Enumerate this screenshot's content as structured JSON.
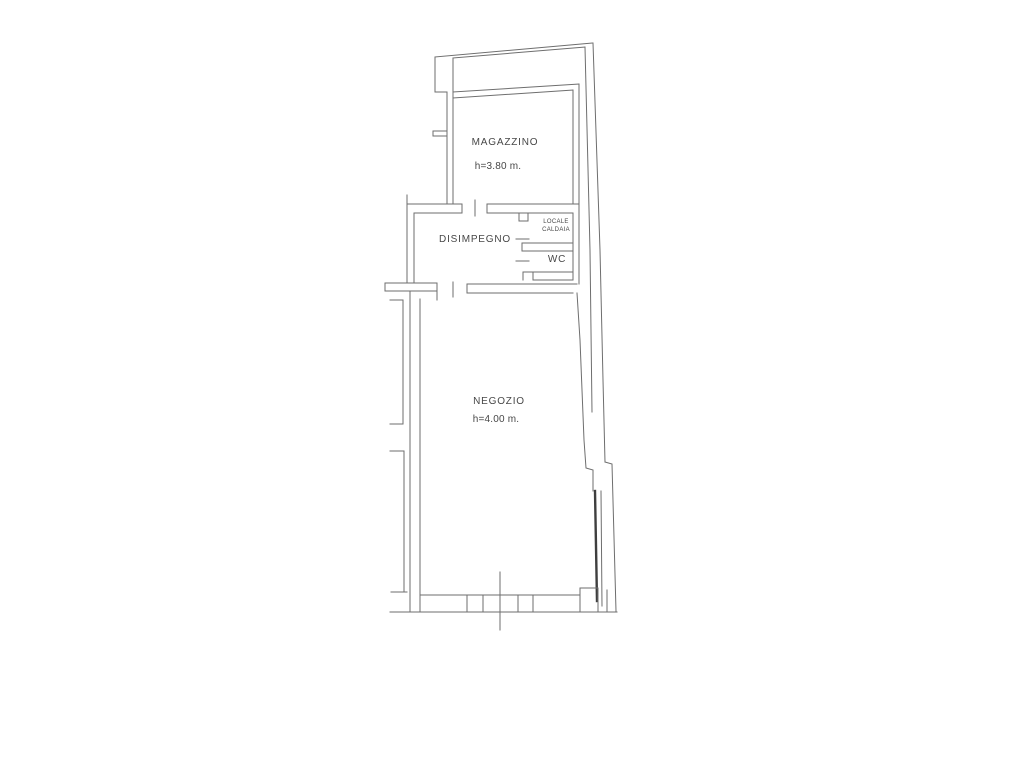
{
  "document_type": "floor-plan-scan",
  "colors": {
    "background": "#ffffff",
    "line": "#6e6e6e",
    "line_dark": "#3f3f3f",
    "text": "#474747"
  },
  "plan": {
    "rooms": {
      "magazzino": {
        "name": "MAGAZZINO",
        "height": "h=3.80 m."
      },
      "disimpegno": {
        "name": "DISIMPEGNO"
      },
      "locale_caldaia": {
        "name_line1": "LOCALE",
        "name_line2": "CALDAIA"
      },
      "wc": {
        "name": "WC"
      },
      "negozio": {
        "name": "NEGOZIO",
        "height": "h=4.00 m."
      }
    }
  },
  "geometry": {
    "polylines": [
      {
        "name": "outer-top-wall-outer-line",
        "points": [
          [
            435,
            57
          ],
          [
            592,
            43
          ]
        ]
      },
      {
        "name": "outer-top-wall-inner-line",
        "points": [
          [
            453,
            58
          ],
          [
            585,
            47
          ]
        ]
      },
      {
        "name": "outer-top-left-step-vertical",
        "points": [
          [
            435,
            57
          ],
          [
            435,
            92
          ]
        ]
      },
      {
        "name": "outer-top-left-step-horizontal",
        "points": [
          [
            435,
            92
          ],
          [
            447,
            92
          ]
        ]
      },
      {
        "name": "magazzino-left-wall-outer",
        "points": [
          [
            447,
            92
          ],
          [
            447,
            203
          ]
        ]
      },
      {
        "name": "magazzino-left-wall-inner",
        "points": [
          [
            453,
            58
          ],
          [
            453,
            203
          ]
        ]
      },
      {
        "name": "magazzino-top-wall-outer",
        "points": [
          [
            453,
            92
          ],
          [
            579,
            84
          ]
        ]
      },
      {
        "name": "magazzino-top-wall-inner",
        "points": [
          [
            453,
            98
          ],
          [
            573,
            90
          ]
        ]
      },
      {
        "name": "magazzino-right-wall-inner",
        "points": [
          [
            573,
            90
          ],
          [
            573,
            204
          ]
        ]
      },
      {
        "name": "magazzino-right-wall-outer",
        "points": [
          [
            579,
            84
          ],
          [
            579,
            213
          ]
        ]
      },
      {
        "name": "boundary-right-inner-line",
        "points": [
          [
            585,
            47
          ],
          [
            590,
            250
          ],
          [
            592,
            412
          ]
        ]
      },
      {
        "name": "boundary-right-outer-line",
        "points": [
          [
            593,
            43
          ],
          [
            600,
            250
          ],
          [
            603,
            380
          ],
          [
            605,
            462
          ]
        ]
      },
      {
        "name": "boundary-right-outer-lower",
        "points": [
          [
            605,
            462
          ],
          [
            612,
            464
          ],
          [
            616,
            611
          ]
        ]
      },
      {
        "name": "wall-stub-left-of-magazzino-top",
        "points": [
          [
            433,
            131
          ],
          [
            447,
            131
          ]
        ]
      },
      {
        "name": "wall-stub-left-of-magazzino-bot",
        "points": [
          [
            433,
            136
          ],
          [
            447,
            136
          ]
        ]
      },
      {
        "name": "wall-stub-left-of-magazzino-cap",
        "points": [
          [
            433,
            131
          ],
          [
            433,
            136
          ]
        ]
      },
      {
        "name": "disimpegno-top-wall-upper",
        "points": [
          [
            407,
            204
          ],
          [
            462,
            204
          ]
        ]
      },
      {
        "name": "disimpegno-top-wall-lower",
        "points": [
          [
            414,
            213
          ],
          [
            462,
            213
          ]
        ]
      },
      {
        "name": "disimpegno-top-wall-cap",
        "points": [
          [
            462,
            204
          ],
          [
            462,
            213
          ]
        ]
      },
      {
        "name": "magazzino-door-tick",
        "points": [
          [
            475,
            200
          ],
          [
            475,
            216
          ]
        ]
      },
      {
        "name": "magazzino-south-wall-upper",
        "points": [
          [
            487,
            204
          ],
          [
            579,
            204
          ]
        ]
      },
      {
        "name": "magazzino-south-wall-lower",
        "points": [
          [
            487,
            213
          ],
          [
            573,
            213
          ]
        ]
      },
      {
        "name": "magazzino-south-wall-cap",
        "points": [
          [
            487,
            204
          ],
          [
            487,
            213
          ]
        ]
      },
      {
        "name": "disimpegno-left-wall-outer",
        "points": [
          [
            407,
            195
          ],
          [
            407,
            283
          ]
        ]
      },
      {
        "name": "disimpegno-left-wall-inner",
        "points": [
          [
            414,
            213
          ],
          [
            414,
            283
          ]
        ]
      },
      {
        "name": "disimpegno-bottom-wall-upper",
        "points": [
          [
            385,
            283
          ],
          [
            437,
            283
          ]
        ]
      },
      {
        "name": "disimpegno-bottom-wall-lower",
        "points": [
          [
            385,
            291
          ],
          [
            437,
            291
          ]
        ]
      },
      {
        "name": "disimpegno-bottom-wall-cap-l",
        "points": [
          [
            385,
            283
          ],
          [
            385,
            291
          ]
        ]
      },
      {
        "name": "disimpegno-bottom-wall-cap-r",
        "points": [
          [
            437,
            283
          ],
          [
            437,
            300
          ]
        ]
      },
      {
        "name": "negozio-door-tick",
        "points": [
          [
            453,
            282
          ],
          [
            453,
            297
          ]
        ]
      },
      {
        "name": "negozio-top-wall-upper",
        "points": [
          [
            467,
            284
          ],
          [
            577,
            284
          ]
        ]
      },
      {
        "name": "negozio-top-wall-lower",
        "points": [
          [
            467,
            293
          ],
          [
            573,
            293
          ]
        ]
      },
      {
        "name": "negozio-top-wall-cap",
        "points": [
          [
            467,
            284
          ],
          [
            467,
            293
          ]
        ]
      },
      {
        "name": "negozio-left-wall-outer",
        "points": [
          [
            410,
            291
          ],
          [
            410,
            611
          ]
        ]
      },
      {
        "name": "negozio-left-wall-inner",
        "points": [
          [
            420,
            299
          ],
          [
            420,
            611
          ]
        ]
      },
      {
        "name": "caldaia-door-jamb",
        "points": [
          [
            519,
            213
          ],
          [
            519,
            221
          ],
          [
            528,
            221
          ],
          [
            528,
            213
          ]
        ]
      },
      {
        "name": "caldaia-door-leaf-dash",
        "points": [
          [
            516,
            239
          ],
          [
            529,
            239
          ]
        ]
      },
      {
        "name": "caldaia-wc-wall-upper",
        "points": [
          [
            522,
            243
          ],
          [
            573,
            243
          ]
        ]
      },
      {
        "name": "caldaia-wc-wall-lower",
        "points": [
          [
            522,
            251
          ],
          [
            573,
            251
          ]
        ]
      },
      {
        "name": "caldaia-wc-wall-cap",
        "points": [
          [
            522,
            243
          ],
          [
            522,
            251
          ]
        ]
      },
      {
        "name": "wc-door-leaf-dash",
        "points": [
          [
            516,
            261
          ],
          [
            529,
            261
          ]
        ]
      },
      {
        "name": "wc-bottom-wall-upper",
        "points": [
          [
            523,
            272
          ],
          [
            573,
            272
          ]
        ]
      },
      {
        "name": "wc-bottom-wall-lower",
        "points": [
          [
            533,
            280
          ],
          [
            573,
            280
          ]
        ]
      },
      {
        "name": "wc-door-jamb",
        "points": [
          [
            523,
            280
          ],
          [
            523,
            272
          ],
          [
            533,
            272
          ],
          [
            533,
            280
          ]
        ]
      },
      {
        "name": "caldaia-wc-right-wall-inner",
        "points": [
          [
            573,
            213
          ],
          [
            573,
            280
          ]
        ]
      },
      {
        "name": "caldaia-wc-right-wall-outer",
        "points": [
          [
            579,
            213
          ],
          [
            579,
            284
          ]
        ]
      },
      {
        "name": "negozio-right-wall",
        "points": [
          [
            577,
            293
          ],
          [
            580,
            340
          ],
          [
            584,
            440
          ],
          [
            586,
            468
          ],
          [
            593,
            470
          ],
          [
            593,
            491
          ]
        ]
      },
      {
        "name": "entry-door-leaf",
        "dark": true,
        "width": 2.4,
        "points": [
          [
            595,
            491
          ],
          [
            597,
            601
          ]
        ]
      },
      {
        "name": "entry-door-outer-line",
        "points": [
          [
            601,
            491
          ],
          [
            602,
            606
          ]
        ]
      },
      {
        "name": "storefront-top-line",
        "points": [
          [
            421,
            595
          ],
          [
            580,
            595
          ]
        ]
      },
      {
        "name": "storefront-right-step",
        "points": [
          [
            580,
            595
          ],
          [
            580,
            588
          ],
          [
            598,
            588
          ]
        ]
      },
      {
        "name": "storefront-bottom-line",
        "points": [
          [
            390,
            612
          ],
          [
            617,
            612
          ]
        ]
      },
      {
        "name": "storefront-mullion-1",
        "points": [
          [
            467,
            595
          ],
          [
            467,
            612
          ]
        ]
      },
      {
        "name": "storefront-mullion-2",
        "points": [
          [
            483,
            595
          ],
          [
            483,
            612
          ]
        ]
      },
      {
        "name": "storefront-mullion-3",
        "points": [
          [
            518,
            595
          ],
          [
            518,
            612
          ]
        ]
      },
      {
        "name": "storefront-mullion-4",
        "points": [
          [
            533,
            595
          ],
          [
            533,
            612
          ]
        ]
      },
      {
        "name": "storefront-jamb-1",
        "points": [
          [
            580,
            588
          ],
          [
            580,
            612
          ]
        ]
      },
      {
        "name": "storefront-jamb-2",
        "points": [
          [
            598,
            588
          ],
          [
            598,
            612
          ]
        ]
      },
      {
        "name": "storefront-jamb-3",
        "points": [
          [
            607,
            590
          ],
          [
            607,
            612
          ]
        ]
      },
      {
        "name": "section-line",
        "points": [
          [
            500,
            572
          ],
          [
            500,
            630
          ]
        ]
      },
      {
        "name": "neighbor-stub-1",
        "points": [
          [
            390,
            300
          ],
          [
            403,
            300
          ]
        ]
      },
      {
        "name": "neighbor-wall-vertical-1",
        "points": [
          [
            403,
            300
          ],
          [
            403,
            424
          ]
        ]
      },
      {
        "name": "neighbor-stub-2",
        "points": [
          [
            390,
            424
          ],
          [
            403,
            424
          ]
        ]
      },
      {
        "name": "neighbor-stub-3",
        "points": [
          [
            390,
            451
          ],
          [
            404,
            451
          ]
        ]
      },
      {
        "name": "neighbor-wall-vertical-2",
        "points": [
          [
            404,
            451
          ],
          [
            404,
            592
          ]
        ]
      },
      {
        "name": "neighbor-stub-4",
        "points": [
          [
            391,
            592
          ],
          [
            407,
            592
          ]
        ]
      }
    ]
  }
}
